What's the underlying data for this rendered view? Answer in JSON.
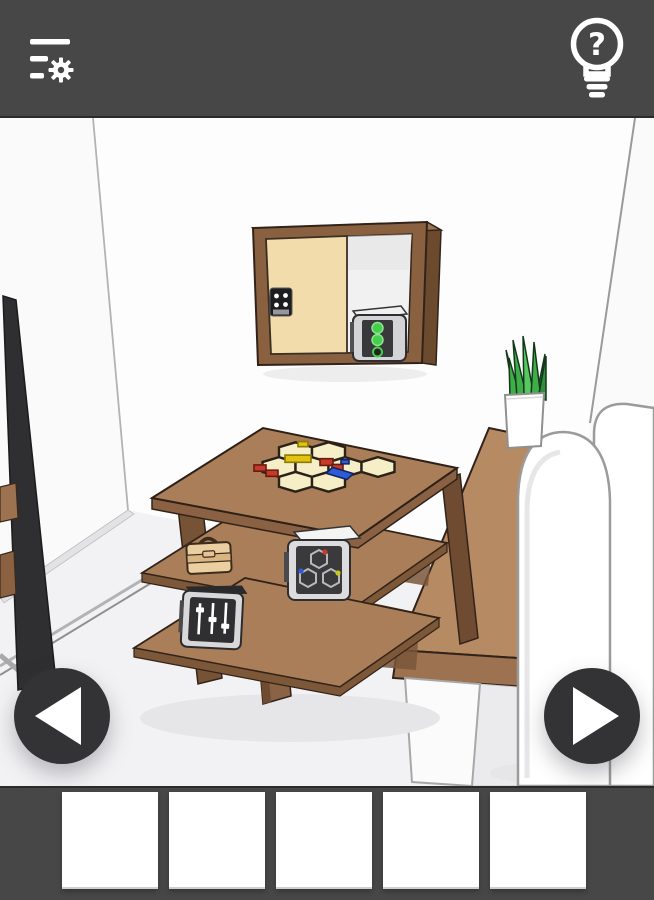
{
  "app": {
    "name": "escape-room-game",
    "screen": "room-view"
  },
  "header": {
    "background_color": "#474747",
    "menu_button": {
      "icon": "menu-settings-icon",
      "label": "Menu and settings"
    },
    "hint_button": {
      "icon": "lightbulb-question-icon",
      "label": "Hint",
      "glyph": "?"
    }
  },
  "navigation": {
    "left_button": {
      "icon": "arrow-left-icon",
      "label": "Turn left"
    },
    "right_button": {
      "icon": "arrow-right-icon",
      "label": "Turn right"
    }
  },
  "inventory": {
    "background_color": "#474747",
    "slot_count": 5,
    "slots": [
      {
        "index": 1,
        "content": "empty",
        "label": "Inventory slot 1 (empty)"
      },
      {
        "index": 2,
        "content": "empty",
        "label": "Inventory slot 2 (empty)"
      },
      {
        "index": 3,
        "content": "empty",
        "label": "Inventory slot 3 (empty)"
      },
      {
        "index": 4,
        "content": "empty",
        "label": "Inventory slot 4 (empty)"
      },
      {
        "index": 5,
        "content": "empty",
        "label": "Inventory slot 5 (empty)"
      }
    ]
  },
  "scene": {
    "description": "3D cartoon room: wall cabinet with keypad sliding door and safe showing green lights, coffee table with hexagon tile puzzle on top, shelves holding a briefcase, a hexagon-dial safe and a slider device, potted plant on wooden console table, white sofa, sliding glass door on the left",
    "objects": [
      {
        "id": "sliding-door",
        "label": "Sliding glass door"
      },
      {
        "id": "wall-cabinet",
        "label": "Wall cabinet"
      },
      {
        "id": "cabinet-door",
        "label": "Cabinet sliding door"
      },
      {
        "id": "cabinet-keypad",
        "label": "Keypad lock"
      },
      {
        "id": "cabinet-safe",
        "label": "Safe with green indicator lights"
      },
      {
        "id": "coffee-table",
        "label": "Coffee table with shelves"
      },
      {
        "id": "hex-puzzle",
        "label": "Hexagon tile puzzle"
      },
      {
        "id": "briefcase",
        "label": "Briefcase"
      },
      {
        "id": "hexagon-safe",
        "label": "Safe with hexagon dials"
      },
      {
        "id": "slider-device",
        "label": "Device with sliders"
      },
      {
        "id": "console-table",
        "label": "Console table"
      },
      {
        "id": "plant",
        "label": "Potted plant"
      },
      {
        "id": "sofa",
        "label": "White sofa"
      }
    ],
    "colors": {
      "wall": "#fdfdfd",
      "wall_left": "#fafafb",
      "floor": "#f2f2f4",
      "wood_mid": "#a97e58",
      "wood_light": "#b68a63",
      "wood_dark": "#7c5839",
      "wood_side": "#6f4c31",
      "wood_frame": "#8a6140",
      "cabinet_door": "#f3dcab",
      "hex_tile": "#f6eec6",
      "accent_green": "#45cf4b",
      "accent_red": "#c63a28",
      "accent_yellow": "#e3c211",
      "accent_blue": "#2e5bd7",
      "plant_green": "#3fae49",
      "briefcase_tan": "#eccfa0"
    }
  }
}
